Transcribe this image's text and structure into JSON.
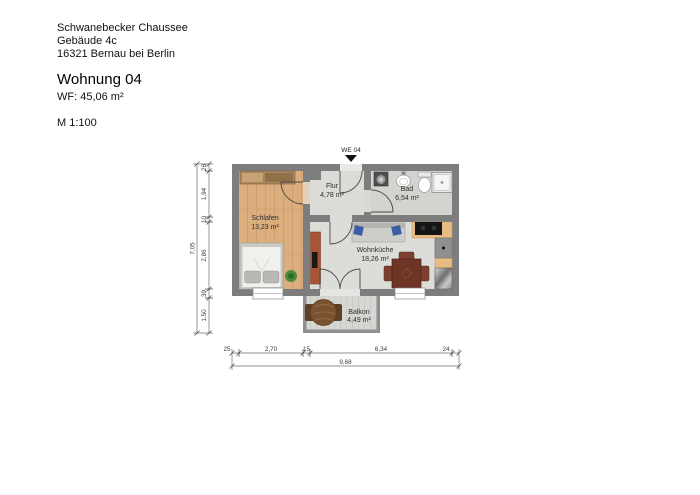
{
  "header": {
    "address_line1": "Schwanebecker Chaussee",
    "address_line2": "Gebäude 4c",
    "address_line3": "16321 Bernau bei Berlin",
    "title": "Wohnung 04",
    "living_area": "WF: 45,06 m²",
    "scale": "M 1:100"
  },
  "floorplan": {
    "unit_label": "WE 04",
    "rooms": [
      {
        "name": "Schlafen",
        "area": "13,23 m²"
      },
      {
        "name": "Flur",
        "area": "4,78 m²"
      },
      {
        "name": "Bad",
        "area": "6,54 m²"
      },
      {
        "name": "Wohnküche",
        "area": "18,26 m²"
      },
      {
        "name": "Balkon",
        "area": "4,49 m²"
      }
    ],
    "dimensions": {
      "vertical_total": "7,05",
      "vertical_segments": [
        "26",
        "1,94",
        "10",
        "2,86",
        "39",
        "1,50"
      ],
      "horizontal_total": "9,68",
      "horizontal_segments": [
        "25",
        "2,70",
        "15",
        "6,34",
        "24"
      ]
    },
    "colors": {
      "wall": "#7d7d7d",
      "balcony_wall": "#8f8f8f",
      "wood_floor": "#dcae7e",
      "tile_floor": "#dbdbd7",
      "bath_floor": "#d3d3cf",
      "balcony_floor": "#d6d6d2"
    }
  }
}
